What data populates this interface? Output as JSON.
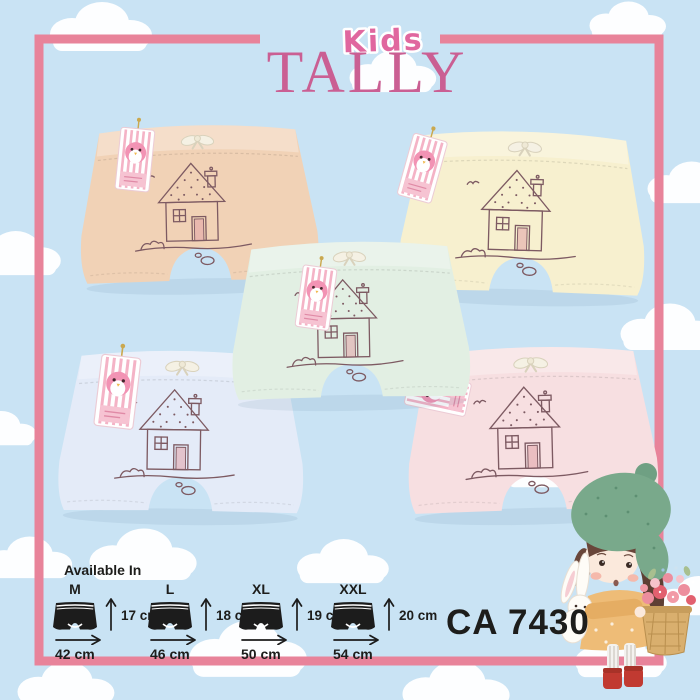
{
  "brand": {
    "kids_label": "Kids",
    "name": "TALLY"
  },
  "product_code": "CA 7430",
  "size_chart": {
    "title": "Available In",
    "sizes": [
      {
        "label": "M",
        "height": "17 cm",
        "width": "42 cm"
      },
      {
        "label": "L",
        "height": "18 cm",
        "width": "46 cm"
      },
      {
        "label": "XL",
        "height": "19 cm",
        "width": "50 cm"
      },
      {
        "label": "XXL",
        "height": "20 cm",
        "width": "54 cm"
      }
    ]
  },
  "products": [
    {
      "name": "peach boxer",
      "color": "#f1d2b6"
    },
    {
      "name": "cream boxer",
      "color": "#f7f0cf"
    },
    {
      "name": "mint boxer",
      "color": "#e2efe3"
    },
    {
      "name": "light-blue boxer",
      "color": "#e4ebf8"
    },
    {
      "name": "pink boxer",
      "color": "#f7dfe1"
    }
  ],
  "colors": {
    "sky": "#c9e3f4",
    "frame": "#e8839a",
    "logo_pink": "#ca5f93",
    "kids_pink": "#e0679f",
    "print_line": "#7d5a62",
    "chart_ink": "#1d1d1b"
  }
}
